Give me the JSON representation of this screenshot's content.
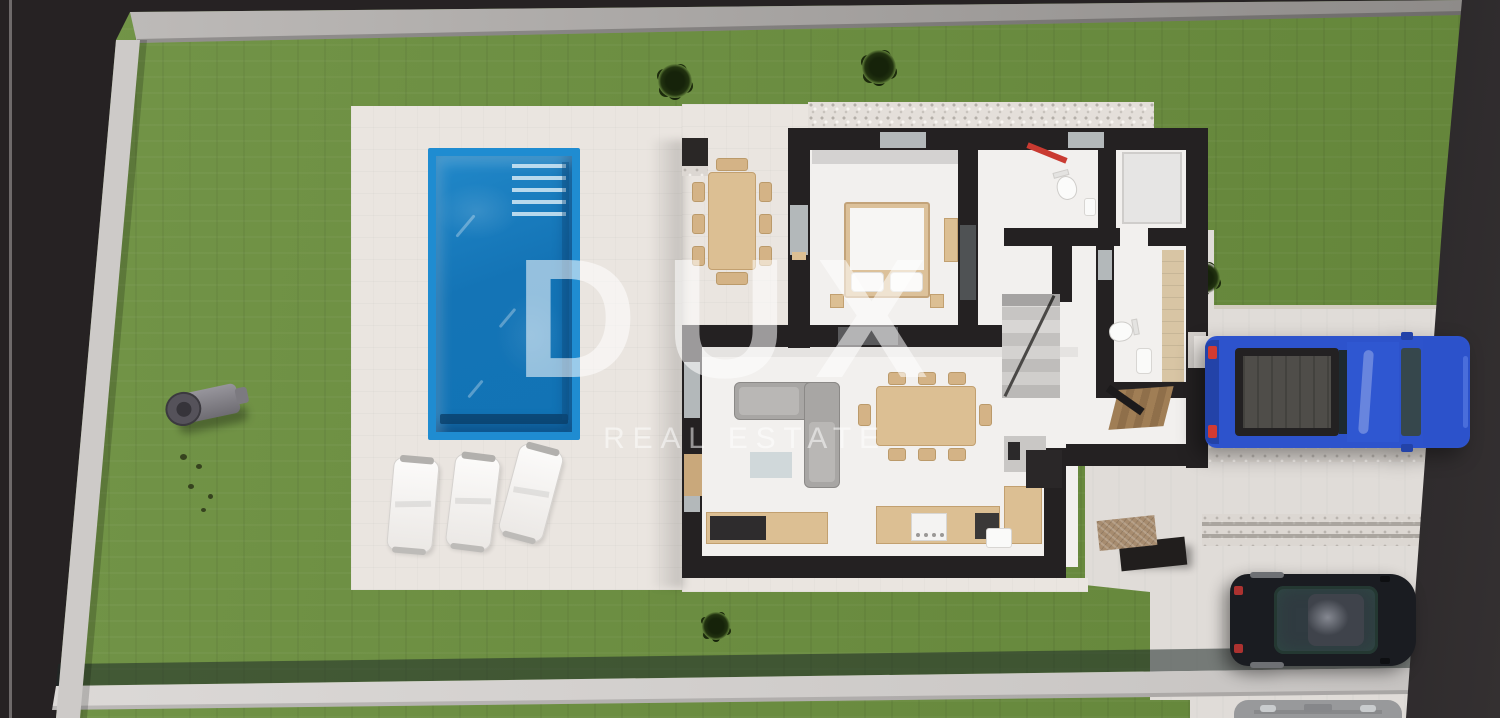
{
  "watermark": {
    "brand": "DUX",
    "tagline": "REAL ESTATE"
  },
  "scene": {
    "type": "3d-rendered-floor-plan-site-view",
    "description": "Top-down architectural render of a villa plot: lawn, paved patio with rectangular pool and three sun loungers, single-storey house floor plan with furniture, gravel driveway at right with a blue pickup truck, a dark car and a partially visible gray car, enclosed by light boundary walls over a dark backdrop.",
    "palette": {
      "lawn": "#6b8f3e",
      "patio": "#eae5e0",
      "pool_rim": "#1f8cd1",
      "pool_water": "#1474b6",
      "wall_dark": "#242122",
      "frame_wall": "#cdcac8",
      "backdrop": "#262223",
      "truck_blue": "#2d53cc",
      "car_dark": "#1a1c21",
      "car_gray": "#98999b",
      "wood": "#dcbf93",
      "towel_red": "#c93a31"
    },
    "objects": {
      "pool": "rectangular pool with entry steps, top-right corner",
      "sun_loungers": 3,
      "cars": [
        "blue pickup truck",
        "dark car",
        "gray car (partial, bottom edge)"
      ],
      "rooms": [
        "terrace with dining table and grill",
        "bedroom",
        "bathroom with red towel rail",
        "shower room",
        "hallway with stairs",
        "second bathroom",
        "entry with parquet",
        "living room with L-sofa",
        "dining area",
        "kitchen"
      ],
      "misc": [
        "stone bench",
        "gray cylinder tank on lawn",
        "4 shrubs",
        "gravel strips"
      ]
    }
  }
}
